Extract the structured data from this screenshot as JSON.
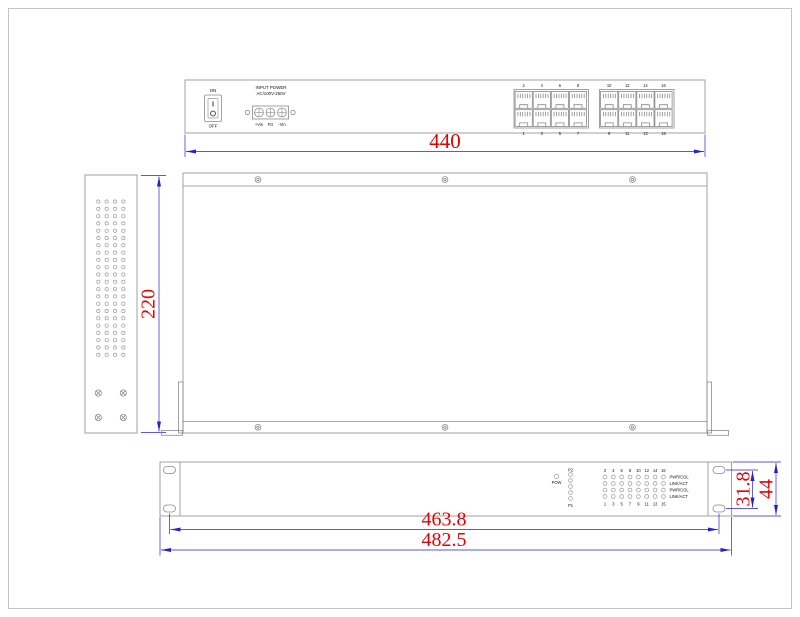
{
  "colors": {
    "geometry": "#8a8a8a",
    "dimension_line": "#2323cc",
    "dimension_text": "#e60000",
    "label_text": "#111111",
    "background": "#ffffff",
    "border": "#c4c4c4"
  },
  "rear_view": {
    "power_switch": {
      "on_label": "ON",
      "off_label": "OFF"
    },
    "power_input": {
      "title_line1": "INPUT POWER",
      "title_line2": "AC/100V-250V",
      "terminal_labels": [
        "+Vin",
        "FG",
        "-Vin"
      ]
    },
    "port_groups": [
      {
        "top_numbers": [
          "2",
          "4",
          "6",
          "8"
        ],
        "bottom_numbers": [
          "1",
          "3",
          "5",
          "7"
        ]
      },
      {
        "top_numbers": [
          "10",
          "12",
          "14",
          "16"
        ],
        "bottom_numbers": [
          "9",
          "11",
          "13",
          "15"
        ]
      }
    ],
    "width_dim": "440"
  },
  "side_view": {
    "height_dim": "220",
    "vent_hole_grid": {
      "rows": 22,
      "cols": 4
    },
    "screw_count": 4
  },
  "plan_view": {
    "screw_count_top": 3,
    "screw_count_bottom": 3
  },
  "front_view": {
    "led_panel": {
      "power_led_label": "POW",
      "fiber_top_label": "P2",
      "fiber_bottom_label": "P1",
      "fiber_led_count": 5,
      "port_numbers_top": [
        "2",
        "4",
        "6",
        "8",
        "10",
        "12",
        "14",
        "16"
      ],
      "port_numbers_bottom": [
        "1",
        "3",
        "5",
        "7",
        "9",
        "11",
        "13",
        "15"
      ],
      "row_labels": [
        "PWR/COL",
        "LINK/ACT",
        "PWR/COL",
        "LINK/ACT"
      ],
      "led_grid": {
        "rows": 4,
        "cols": 8
      }
    },
    "mounting_holes_dim": "463.8",
    "overall_width_dim": "482.5",
    "ear_slot_dim": "31.8",
    "height_dim": "44"
  }
}
